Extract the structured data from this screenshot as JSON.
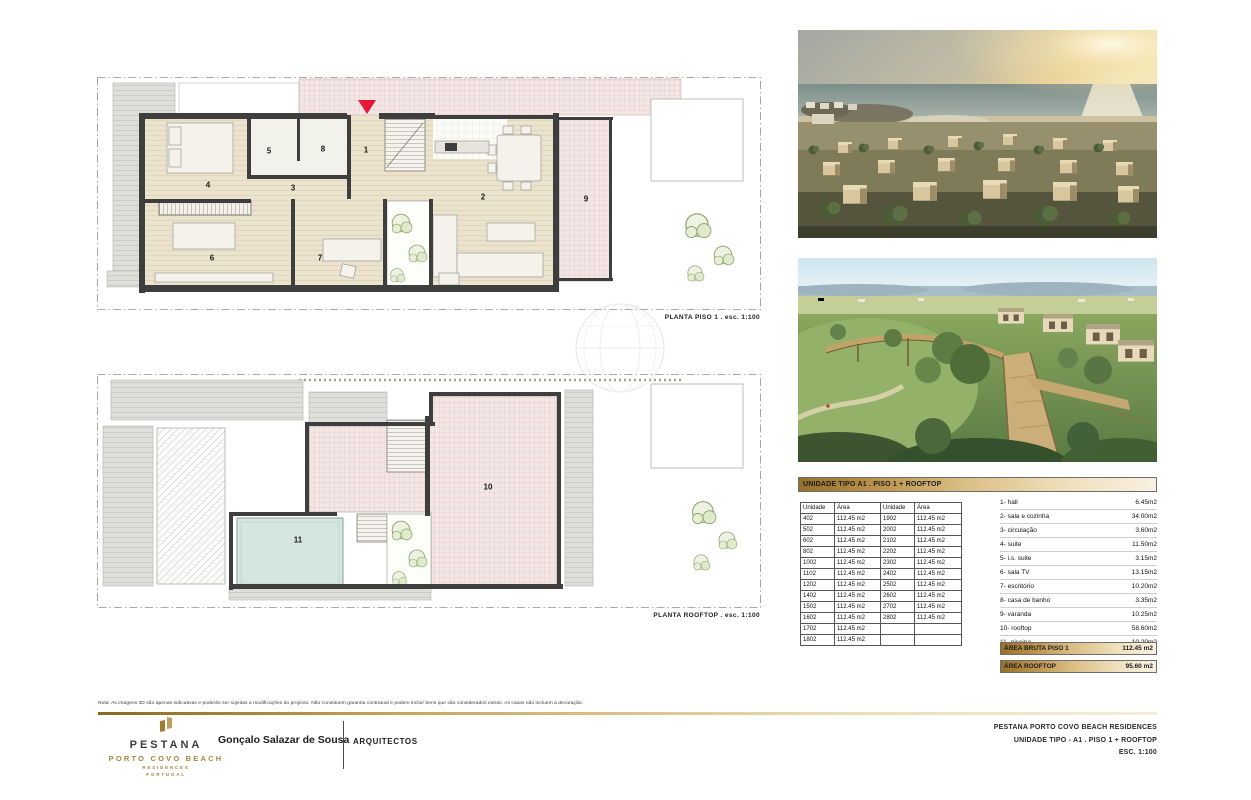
{
  "sheet": {
    "plans": {
      "piso1": {
        "caption": "PLANTA PISO 1  .  esc. 1:100",
        "rooms": [
          "1",
          "2",
          "3",
          "4",
          "5",
          "6",
          "7",
          "8",
          "9"
        ]
      },
      "rooftop": {
        "caption": "PLANTA ROOFTOP  .  esc. 1:100",
        "rooms": [
          "10",
          "11"
        ]
      }
    },
    "photos": [
      {
        "name": "aerial-beach-resort-render"
      },
      {
        "name": "park-boardwalk-render"
      }
    ],
    "units_table": {
      "title": "UNIDADE TIPO A1 . PISO 1 + ROOFTOP",
      "columns": [
        "Unidade",
        "Área",
        "Unidade",
        "Área"
      ],
      "rows": [
        [
          "402",
          "112.45 m2",
          "1902",
          "112.45 m2"
        ],
        [
          "502",
          "112.45 m2",
          "2002",
          "112.45 m2"
        ],
        [
          "602",
          "112.45 m2",
          "2102",
          "112.45 m2"
        ],
        [
          "802",
          "112.45 m2",
          "2202",
          "112.45 m2"
        ],
        [
          "1002",
          "112.45 m2",
          "2302",
          "112.45 m2"
        ],
        [
          "1102",
          "112.45 m2",
          "2402",
          "112.45 m2"
        ],
        [
          "1202",
          "112.45 m2",
          "2502",
          "112.45 m2"
        ],
        [
          "1402",
          "112.45 m2",
          "2602",
          "112.45 m2"
        ],
        [
          "1502",
          "112.45 m2",
          "2702",
          "112.45 m2"
        ],
        [
          "1602",
          "112.45 m2",
          "2802",
          "112.45 m2"
        ],
        [
          "1702",
          "112.45 m2",
          "",
          ""
        ],
        [
          "1802",
          "112.45 m2",
          "",
          ""
        ]
      ]
    },
    "legend": {
      "items": [
        {
          "label": "1- hall",
          "area": "6.45m2"
        },
        {
          "label": "2- sala e cozinha",
          "area": "34.00m2"
        },
        {
          "label": "3- circulação",
          "area": "3.60m2"
        },
        {
          "label": "4- suite",
          "area": "11.50m2"
        },
        {
          "label": "5- i.s. suite",
          "area": "3.15m2"
        },
        {
          "label": "6- sala TV",
          "area": "13.15m2"
        },
        {
          "label": "7- escritório",
          "area": "10.20m2"
        },
        {
          "label": "8- casa de banho",
          "area": "3.35m2"
        },
        {
          "label": "9- varanda",
          "area": "10.25m2"
        },
        {
          "label": "10- rooftop",
          "area": "58.60m2"
        },
        {
          "label": "11- piscina",
          "area": "10.20m2"
        }
      ],
      "totals": [
        {
          "label": "ÁREA BRUTA PISO 1",
          "area": "112.45 m2"
        },
        {
          "label": "ÁREA ROOFTOP",
          "area": "95.60 m2"
        }
      ]
    },
    "footer": {
      "note": "Nota: As imagens 3D são apenas indicativas e poderão ser sujeitas a modificações do projecto. Não constituem garantia contratual e podem incluir bens que são considerados extras. As casas não incluem a decoração.",
      "brand": {
        "name": "PESTANA",
        "location": "PORTO COVO BEACH",
        "line3": "RESIDENCES",
        "line4": "PORTUGAL"
      },
      "architect": "Gonçalo Salazar de Sousa",
      "architect_title": "ARQUITECTOS",
      "project_lines": [
        "PESTANA PORTO COVO BEACH RESIDENCES",
        "UNIDADE TIPO - A1 . PISO 1 + ROOFTOP",
        "ESC. 1:100"
      ]
    },
    "colors": {
      "gold_dark": "#96702a",
      "gold_light": "#f8f1e2",
      "brand_gold": "#a5873f",
      "entrance_red": "#e51937",
      "wall": "#3e3e3e",
      "floor": "#ebe3cd",
      "tile_pink": "#f3e6e4",
      "pool": "#d5e5e0"
    }
  }
}
